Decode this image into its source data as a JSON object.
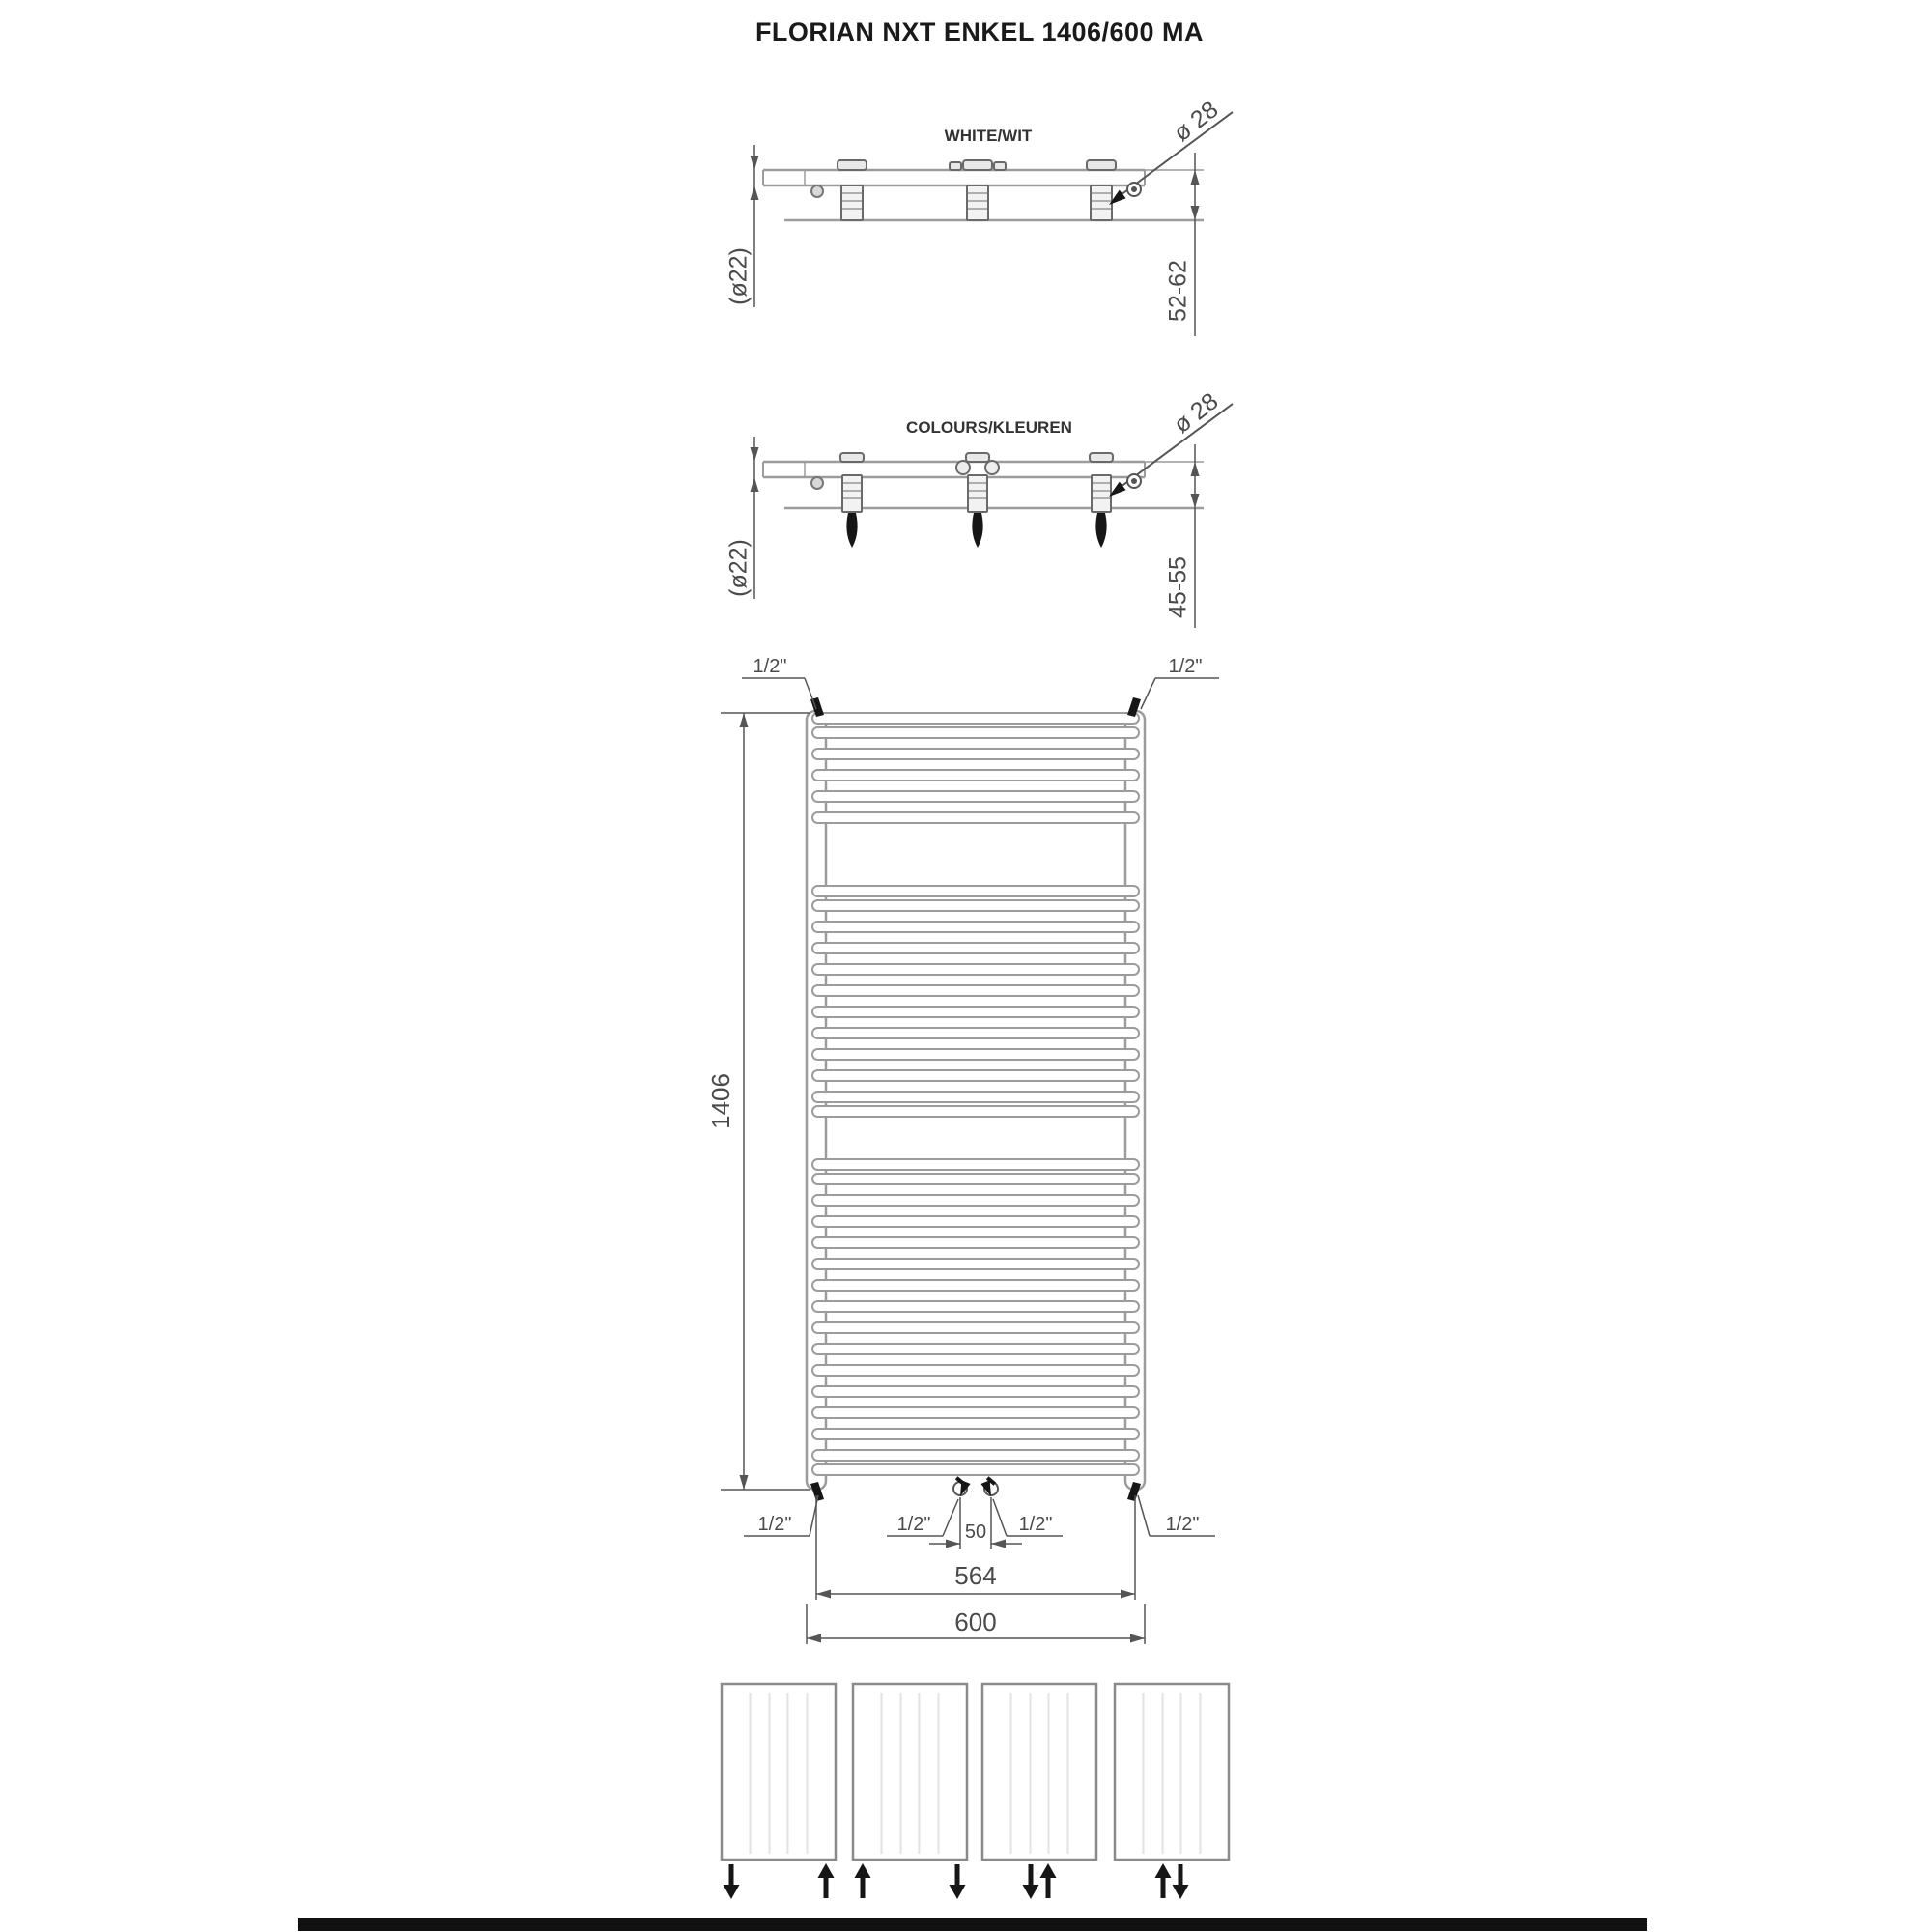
{
  "title": "FLORIAN NXT ENKEL 1406/600 MA",
  "views": {
    "white": {
      "label": "WHITE/WIT",
      "tube_diameter": "(ø22)",
      "plug_diameter": "ø 28",
      "wall_distance": "52-62"
    },
    "colours": {
      "label": "COLOURS/KLEUREN",
      "tube_diameter": "(ø22)",
      "plug_diameter": "ø 28",
      "wall_distance": "45-55"
    }
  },
  "front_view": {
    "height": "1406",
    "width": "600",
    "connection_pitch": "564",
    "center_spacing": "50",
    "connections": {
      "top_left": "1/2\"",
      "top_right": "1/2\"",
      "bottom_outer_left": "1/2\"",
      "bottom_mid_left": "1/2\"",
      "bottom_mid_right": "1/2\"",
      "bottom_outer_right": "1/2\""
    },
    "tube_groups": [
      6,
      12,
      16
    ]
  },
  "connection_options": [
    {
      "id": "option-1",
      "arrows": [
        {
          "dir": "down",
          "pos": "left"
        },
        {
          "dir": "up",
          "pos": "right"
        }
      ]
    },
    {
      "id": "option-2",
      "arrows": [
        {
          "dir": "up",
          "pos": "left"
        },
        {
          "dir": "down",
          "pos": "right"
        }
      ]
    },
    {
      "id": "option-3",
      "arrows": [
        {
          "dir": "down",
          "pos": "center-left"
        },
        {
          "dir": "up",
          "pos": "center-right"
        }
      ]
    },
    {
      "id": "option-4",
      "arrows": [
        {
          "dir": "up",
          "pos": "center-left"
        },
        {
          "dir": "down",
          "pos": "center-right"
        }
      ]
    }
  ],
  "colors": {
    "drawing_line": "#9c9c9c",
    "dimension": "#555555",
    "bracket": "#6a6a6a",
    "text": "#3f3f3f",
    "black": "#161616"
  }
}
